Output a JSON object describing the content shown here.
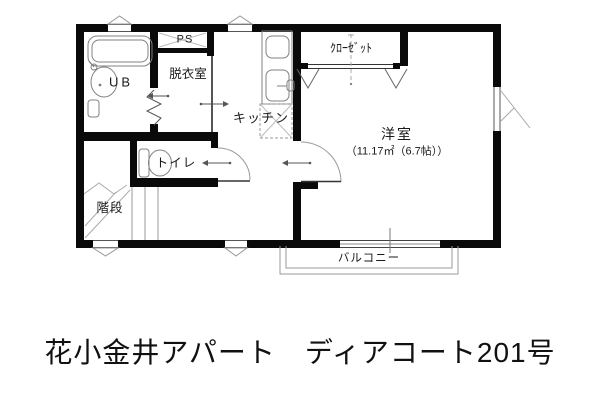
{
  "title": "花小金井アパート　ディアコート201号",
  "colors": {
    "wall": "#0a0a0a",
    "fixture_line": "#808080",
    "thin_line": "#999999",
    "text": "#1a1a1a"
  },
  "rooms": {
    "unit_bath": {
      "label": "UB"
    },
    "pipe_space": {
      "label": "PS"
    },
    "dressing_room": {
      "label": "脱衣室"
    },
    "kitchen": {
      "label": "キッチン"
    },
    "closet": {
      "label": "ｸﾛｰｾﾞｯﾄ"
    },
    "western_room": {
      "label": "洋室",
      "area": "（11.17㎡（6.7帖））"
    },
    "toilet": {
      "label": "トイレ"
    },
    "stairs": {
      "label": "階段"
    },
    "balcony": {
      "label": "バルコニー"
    }
  },
  "fixtures": [
    "bathtub-icon",
    "washbasin-icon",
    "faucet-icon",
    "toilet-icon",
    "gas-stove-icon",
    "kitchen-sink-icon",
    "refrigerator-space-icon",
    "closet-hanger-icon",
    "stair-treads-icon",
    "folding-door-icon",
    "door-swing-arc-icon",
    "sliding-window-icon",
    "vent-icon",
    "casement-window-icon",
    "direction-arrow-icon"
  ]
}
